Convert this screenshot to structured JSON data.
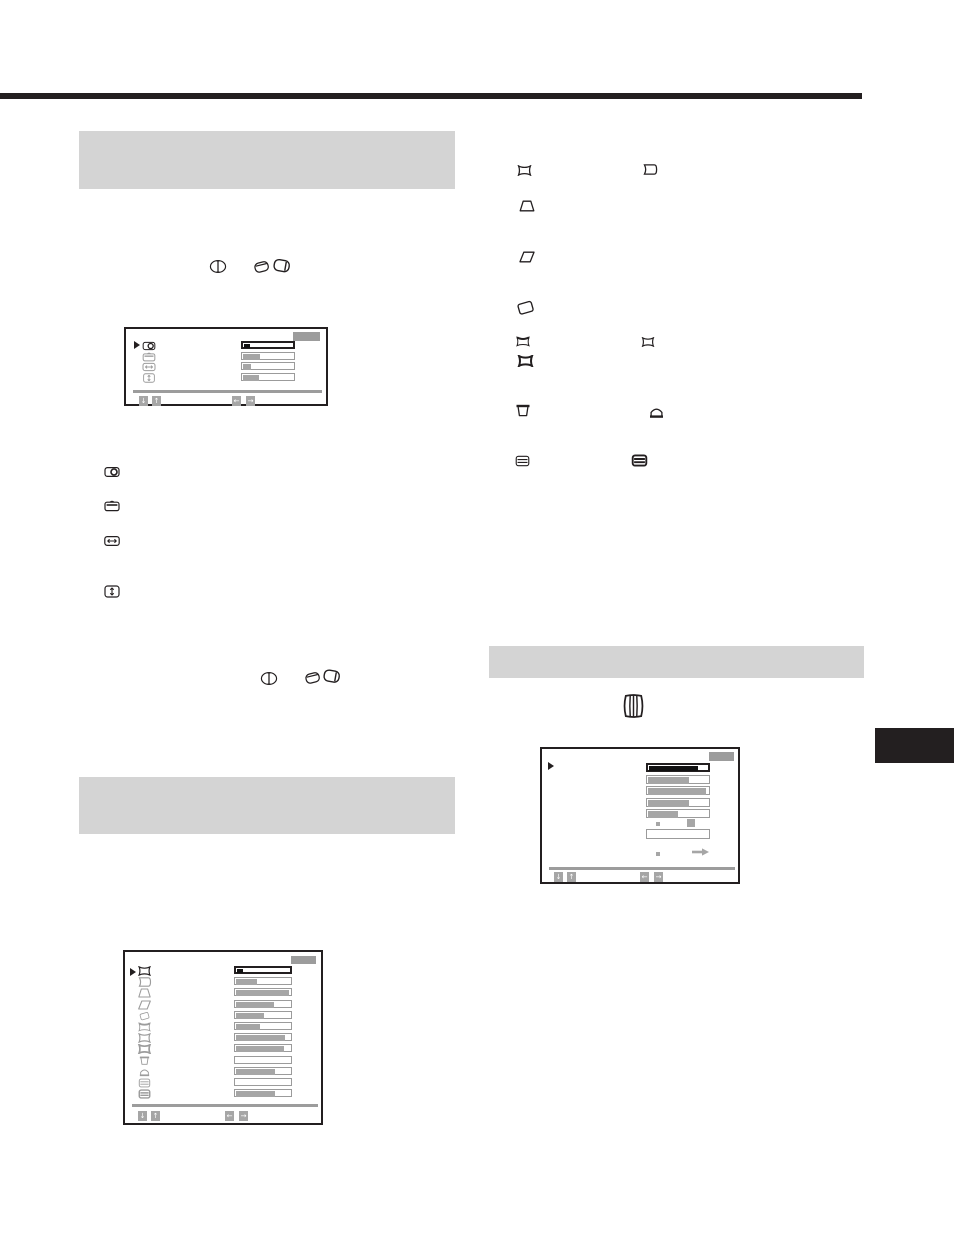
{
  "page": {
    "width": 954,
    "height": 1235,
    "background": "#ffffff"
  },
  "colors": {
    "ink": "#231f20",
    "heading_bar": "#d4d4d4",
    "osd_gray": "#9c9c9c",
    "osd_fill": "#a6a6a6",
    "slider_border": "#9b9b9b",
    "selected_fill": "#111111"
  },
  "decorations": {
    "top_rule": {
      "x": 0,
      "y": 93,
      "w": 862,
      "h": 6
    },
    "side_tab": {
      "x": 875,
      "y": 728,
      "w": 79,
      "h": 35
    },
    "heading_bars": [
      {
        "name": "section-heading-bar-1",
        "x": 79,
        "y": 131,
        "w": 376,
        "h": 58
      },
      {
        "name": "section-heading-bar-2",
        "x": 79,
        "y": 777,
        "w": 376,
        "h": 57
      },
      {
        "name": "section-heading-bar-3",
        "x": 489,
        "y": 646,
        "w": 375,
        "h": 32
      }
    ]
  },
  "standalone_icons": [
    {
      "name": "control-knob-front-icon",
      "icon": "knob-front",
      "x": 209,
      "y": 259,
      "w": 18,
      "h": 15
    },
    {
      "name": "control-knob-tilt-left-icon",
      "icon": "knob-left",
      "x": 252,
      "y": 259,
      "w": 19,
      "h": 15
    },
    {
      "name": "control-knob-tilt-right-icon",
      "icon": "knob-right",
      "x": 272,
      "y": 257,
      "w": 20,
      "h": 17
    },
    {
      "name": "h-center-icon",
      "icon": "h-center",
      "x": 104,
      "y": 466,
      "w": 16,
      "h": 12
    },
    {
      "name": "v-center-icon",
      "icon": "v-center",
      "x": 104,
      "y": 500,
      "w": 16,
      "h": 12
    },
    {
      "name": "h-size-icon",
      "icon": "h-size",
      "x": 104,
      "y": 535,
      "w": 16,
      "h": 12
    },
    {
      "name": "v-size-icon",
      "icon": "v-size",
      "x": 104,
      "y": 585,
      "w": 16,
      "h": 13
    },
    {
      "name": "control-knob-front-icon",
      "icon": "knob-front",
      "x": 260,
      "y": 671,
      "w": 18,
      "h": 15
    },
    {
      "name": "control-knob-tilt-left-icon",
      "icon": "knob-left",
      "x": 303,
      "y": 670,
      "w": 19,
      "h": 15
    },
    {
      "name": "control-knob-tilt-right-icon",
      "icon": "knob-right",
      "x": 322,
      "y": 667,
      "w": 20,
      "h": 18
    },
    {
      "name": "pincushion-icon",
      "icon": "pin",
      "x": 517,
      "y": 165,
      "w": 15,
      "h": 11
    },
    {
      "name": "pin-balance-icon",
      "icon": "pin-balance",
      "x": 642,
      "y": 164,
      "w": 16,
      "h": 11
    },
    {
      "name": "trapezoid-icon",
      "icon": "trapezoid",
      "x": 519,
      "y": 200,
      "w": 16,
      "h": 12
    },
    {
      "name": "parallelogram-icon",
      "icon": "parallelogram",
      "x": 519,
      "y": 251,
      "w": 16,
      "h": 12
    },
    {
      "name": "rotation-icon",
      "icon": "rotated-rect",
      "x": 516,
      "y": 299,
      "w": 19,
      "h": 17
    },
    {
      "name": "top-pincushion-icon",
      "icon": "pin-top",
      "x": 515,
      "y": 336,
      "w": 16,
      "h": 11
    },
    {
      "name": "pincushion-small-icon",
      "icon": "pin",
      "x": 640,
      "y": 337,
      "w": 16,
      "h": 10
    },
    {
      "name": "pincushion-bold-icon",
      "icon": "pin-bold",
      "x": 517,
      "y": 355,
      "w": 17,
      "h": 12
    },
    {
      "name": "top-keystone-icon",
      "icon": "cup",
      "x": 515,
      "y": 404,
      "w": 16,
      "h": 14
    },
    {
      "name": "bottom-keystone-icon",
      "icon": "dome",
      "x": 648,
      "y": 405,
      "w": 17,
      "h": 14
    },
    {
      "name": "linearity-icon",
      "icon": "lines-box",
      "x": 515,
      "y": 455,
      "w": 15,
      "h": 12
    },
    {
      "name": "linearity-bold-icon",
      "icon": "lines-box-bold",
      "x": 631,
      "y": 454,
      "w": 17,
      "h": 13
    },
    {
      "name": "barrel-linearity-icon",
      "icon": "barrel",
      "x": 620,
      "y": 692,
      "w": 27,
      "h": 28
    }
  ],
  "osd_menus": [
    {
      "name": "osd-center-size-menu",
      "x": 124,
      "y": 327,
      "w": 204,
      "h": 79,
      "title_box": {
        "x": 167,
        "y": 3,
        "w": 27,
        "h": 9
      },
      "pointer": {
        "x": 8,
        "y": 12
      },
      "icon_x": 13,
      "icon_w": 20,
      "icon_h": 10,
      "slider_x": 115,
      "slider_w": 54,
      "slider_h": 8,
      "rows": [
        {
          "icon": "h-center",
          "selected": true,
          "fill": 0.11,
          "fill_black": true,
          "row_y": 12
        },
        {
          "icon": "v-center",
          "selected": false,
          "fill": 0.33,
          "row_y": 22.5
        },
        {
          "icon": "h-size",
          "selected": false,
          "fill": 0.15,
          "row_y": 33
        },
        {
          "icon": "v-size",
          "selected": false,
          "fill": 0.3,
          "row_y": 43.5
        }
      ],
      "separator": {
        "x": 7,
        "y": 61,
        "w": 189,
        "h": 3
      },
      "keys": [
        {
          "name": "down-key",
          "glyph": "↓",
          "x": 13,
          "y": 67
        },
        {
          "name": "up-key",
          "glyph": "↑",
          "x": 26,
          "y": 67
        },
        {
          "name": "left-key",
          "glyph": "←",
          "x": 106,
          "y": 67
        },
        {
          "name": "right-key",
          "glyph": "→",
          "x": 120,
          "y": 67
        }
      ]
    },
    {
      "name": "osd-geometry-menu",
      "x": 123,
      "y": 950,
      "w": 200,
      "h": 175,
      "title_box": {
        "x": 166,
        "y": 4,
        "w": 25,
        "h": 8
      },
      "pointer": {
        "x": 5,
        "y": 16
      },
      "icon_x": 10,
      "icon_w": 19,
      "icon_h": 10,
      "slider_x": 109,
      "slider_w": 58,
      "slider_h": 8,
      "rows": [
        {
          "icon": "pin",
          "selected": true,
          "fill": 0.12,
          "fill_black": true,
          "row_y": 14
        },
        {
          "icon": "pin-balance",
          "selected": false,
          "fill": 0.37,
          "row_y": 25.2
        },
        {
          "icon": "trapezoid",
          "selected": false,
          "fill": 0.95,
          "row_y": 36.4
        },
        {
          "icon": "parallelogram",
          "selected": false,
          "fill": 0.68,
          "row_y": 47.6
        },
        {
          "icon": "rotated-rect",
          "selected": false,
          "fill": 0.5,
          "row_y": 58.8
        },
        {
          "icon": "pin-top",
          "selected": false,
          "fill": 0.42,
          "row_y": 70
        },
        {
          "icon": "pin",
          "selected": false,
          "fill": 0.88,
          "row_y": 81.2
        },
        {
          "icon": "pin-bold",
          "selected": false,
          "fill": 0.86,
          "row_y": 92.4
        },
        {
          "icon": "cup",
          "selected": false,
          "fill": 0.0,
          "row_y": 103.6
        },
        {
          "icon": "dome",
          "selected": false,
          "fill": 0.7,
          "row_y": 114.8
        },
        {
          "icon": "lines-box",
          "selected": false,
          "fill": 0.0,
          "row_y": 126
        },
        {
          "icon": "lines-box-bold",
          "selected": false,
          "fill": 0.7,
          "row_y": 137.2
        }
      ],
      "separator": {
        "x": 7,
        "y": 152,
        "w": 186,
        "h": 3
      },
      "keys": [
        {
          "name": "down-key",
          "glyph": "↓",
          "x": 13,
          "y": 159
        },
        {
          "name": "up-key",
          "glyph": "↑",
          "x": 26,
          "y": 159
        },
        {
          "name": "left-key",
          "glyph": "←",
          "x": 100,
          "y": 159
        },
        {
          "name": "right-key",
          "glyph": "→",
          "x": 114,
          "y": 159
        }
      ]
    },
    {
      "name": "osd-option-menu",
      "x": 540,
      "y": 747,
      "w": 200,
      "h": 137,
      "title_box": {
        "x": 167,
        "y": 3,
        "w": 25,
        "h": 9
      },
      "pointer": {
        "x": 6,
        "y": 13
      },
      "icon_x": -100,
      "icon_w": 0,
      "icon_h": 0,
      "slider_x": 104,
      "slider_w": 64,
      "slider_h": 9,
      "rows": [
        {
          "icon": "",
          "selected": true,
          "fill": 0.82,
          "fill_black": true,
          "bar": true,
          "row_y": 14
        },
        {
          "icon": "",
          "selected": false,
          "fill": 0.66,
          "row_y": 25.5
        },
        {
          "icon": "",
          "selected": false,
          "fill": 0.94,
          "row_y": 37
        },
        {
          "icon": "",
          "selected": false,
          "fill": 0.66,
          "row_y": 48.5
        },
        {
          "icon": "",
          "selected": false,
          "fill": 0.49,
          "row_y": 60
        }
      ],
      "extras": [
        {
          "type": "sq",
          "x": 114,
          "y": 73,
          "w": 4,
          "h": 4,
          "name": "option-dot"
        },
        {
          "type": "sq",
          "x": 145,
          "y": 70,
          "w": 8,
          "h": 8,
          "name": "option-selected-square"
        },
        {
          "type": "box",
          "x": 104,
          "y": 80,
          "w": 64,
          "h": 10,
          "name": "option-empty-field"
        },
        {
          "type": "arrow",
          "x": 150,
          "y": 92,
          "w": 17,
          "h": 8,
          "name": "option-arrow-right"
        },
        {
          "type": "sq",
          "x": 114,
          "y": 103,
          "w": 4,
          "h": 4,
          "name": "option-dot"
        }
      ],
      "separator": {
        "x": 7,
        "y": 118,
        "w": 186,
        "h": 3
      },
      "keys": [
        {
          "name": "down-key",
          "glyph": "↓",
          "x": 12,
          "y": 123
        },
        {
          "name": "up-key",
          "glyph": "↑",
          "x": 25,
          "y": 123
        },
        {
          "name": "left-key",
          "glyph": "←",
          "x": 98,
          "y": 123
        },
        {
          "name": "right-key",
          "glyph": "→",
          "x": 112,
          "y": 123
        }
      ]
    }
  ]
}
